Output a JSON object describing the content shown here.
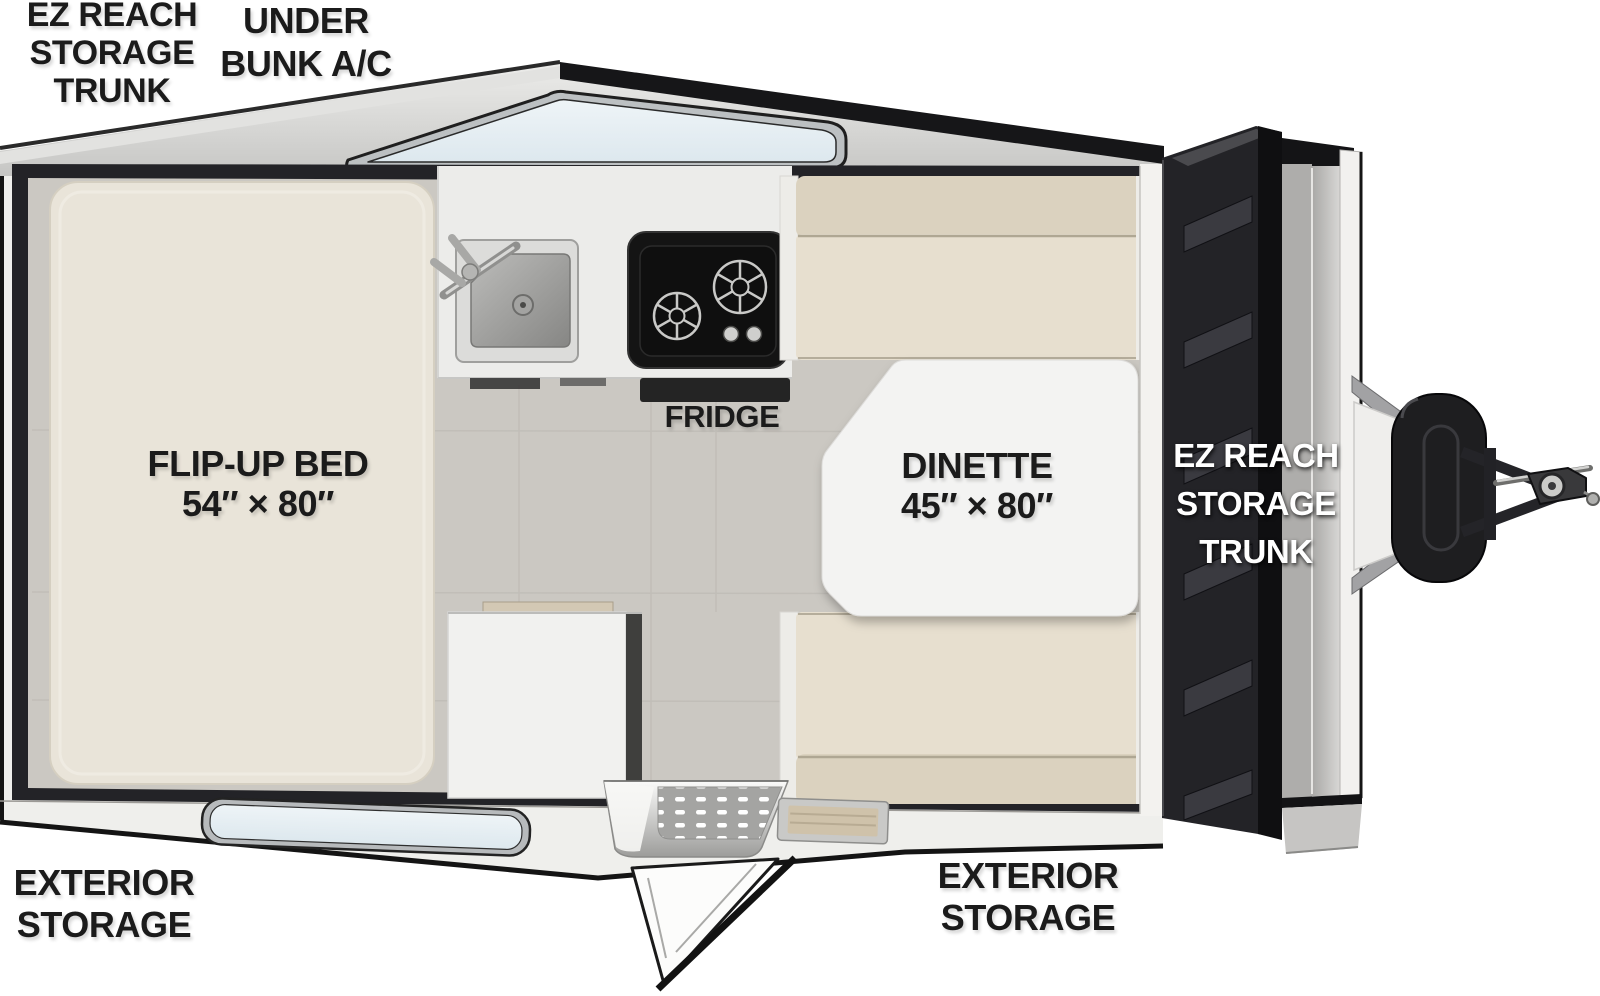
{
  "floorplan": {
    "type": "a-frame-camper-floorplan",
    "labels": {
      "front_trunk": {
        "lines": [
          "EZ REACH",
          "STORAGE",
          "TRUNK"
        ]
      },
      "under_bunk_ac": {
        "lines": [
          "UNDER",
          "BUNK A/C"
        ]
      },
      "flip_up_bed": {
        "title": "FLIP-UP BED",
        "dimensions": "54″ × 80″"
      },
      "fridge": {
        "title": "FRIDGE"
      },
      "dinette": {
        "title": "DINETTE",
        "dimensions": "45″ × 80″"
      },
      "rear_trunk": {
        "lines": [
          "EZ REACH",
          "STORAGE",
          "TRUNK"
        ]
      },
      "exterior_storage_left": {
        "lines": [
          "EXTERIOR",
          "STORAGE"
        ]
      },
      "exterior_storage_right": {
        "lines": [
          "EXTERIOR",
          "STORAGE"
        ]
      }
    },
    "colors": {
      "background": "#ffffff",
      "label_ink": "#1b1b1b",
      "label_on_dark": "#ffffff",
      "floor_tile": "#cbc8c2",
      "bed_cushion": "#e9e4d9",
      "bench_cushion": "#e7dfcf",
      "bench_backrest": "#dbd2bf",
      "table_top": "#f3f3f2",
      "counter_top": "#ececea",
      "stove_black": "#141414",
      "window_glass": "#e9f0f4",
      "trunk_door": "#232327",
      "wall_dark": "#232327",
      "hitch_metal": "#a2a2a4"
    }
  }
}
